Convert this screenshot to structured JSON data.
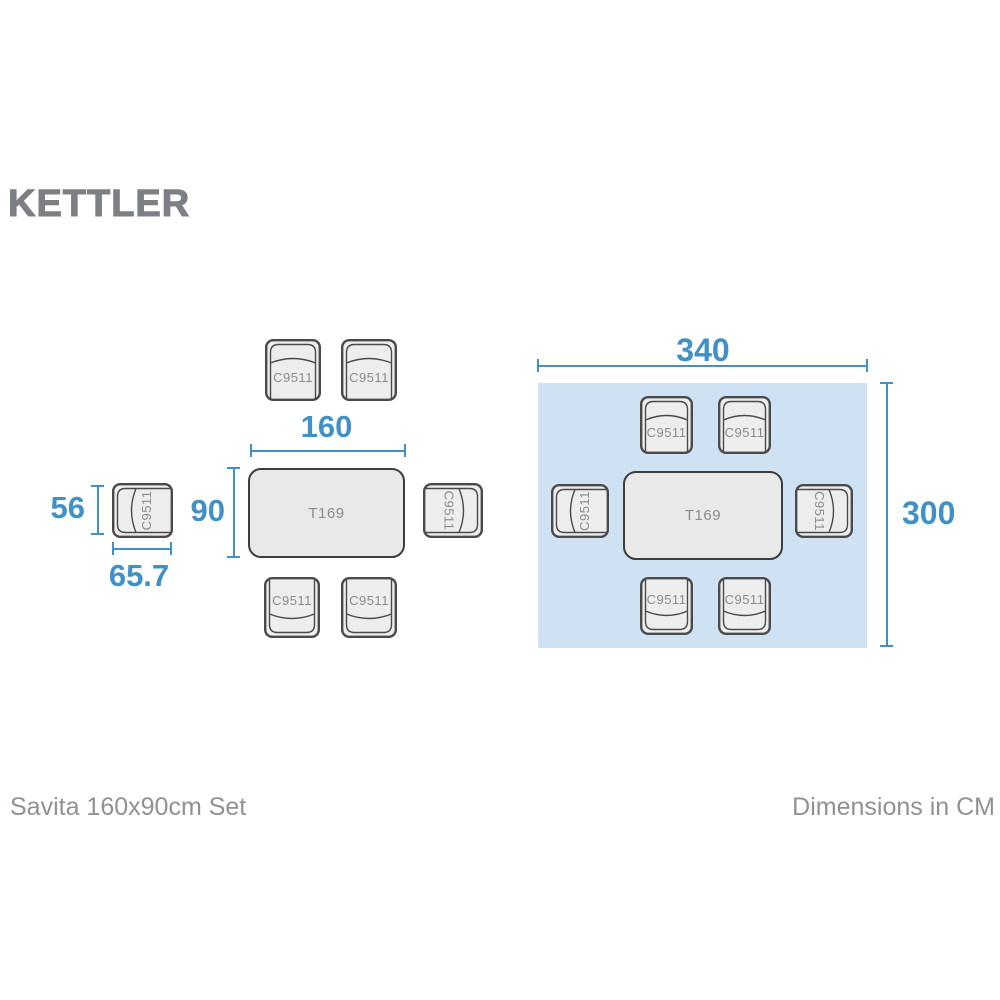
{
  "brand": {
    "name": "KETTLER"
  },
  "set_diagram": {
    "table_label": "T169",
    "chair_label": "C9511",
    "table_width": "160",
    "table_depth": "90",
    "chair_width": "56",
    "chair_depth": "65.7"
  },
  "footprint_diagram": {
    "table_label": "T169",
    "chair_label": "C9511",
    "width": "340",
    "depth": "300"
  },
  "footer": {
    "product_name": "Savita 160x90cm Set",
    "units_note": "Dimensions in CM"
  },
  "colors": {
    "dimension_blue": "#4190c6",
    "footprint_fill": "#cfe2f3",
    "chair_fill": "#ededed",
    "chair_stroke": "#4a4a4a",
    "table_fill": "#e9e9e9",
    "table_stroke": "#3d3d3d",
    "item_label_gray": "#8b8b8b",
    "logo_gray": "#7c8084",
    "footer_gray": "#8e9297"
  }
}
